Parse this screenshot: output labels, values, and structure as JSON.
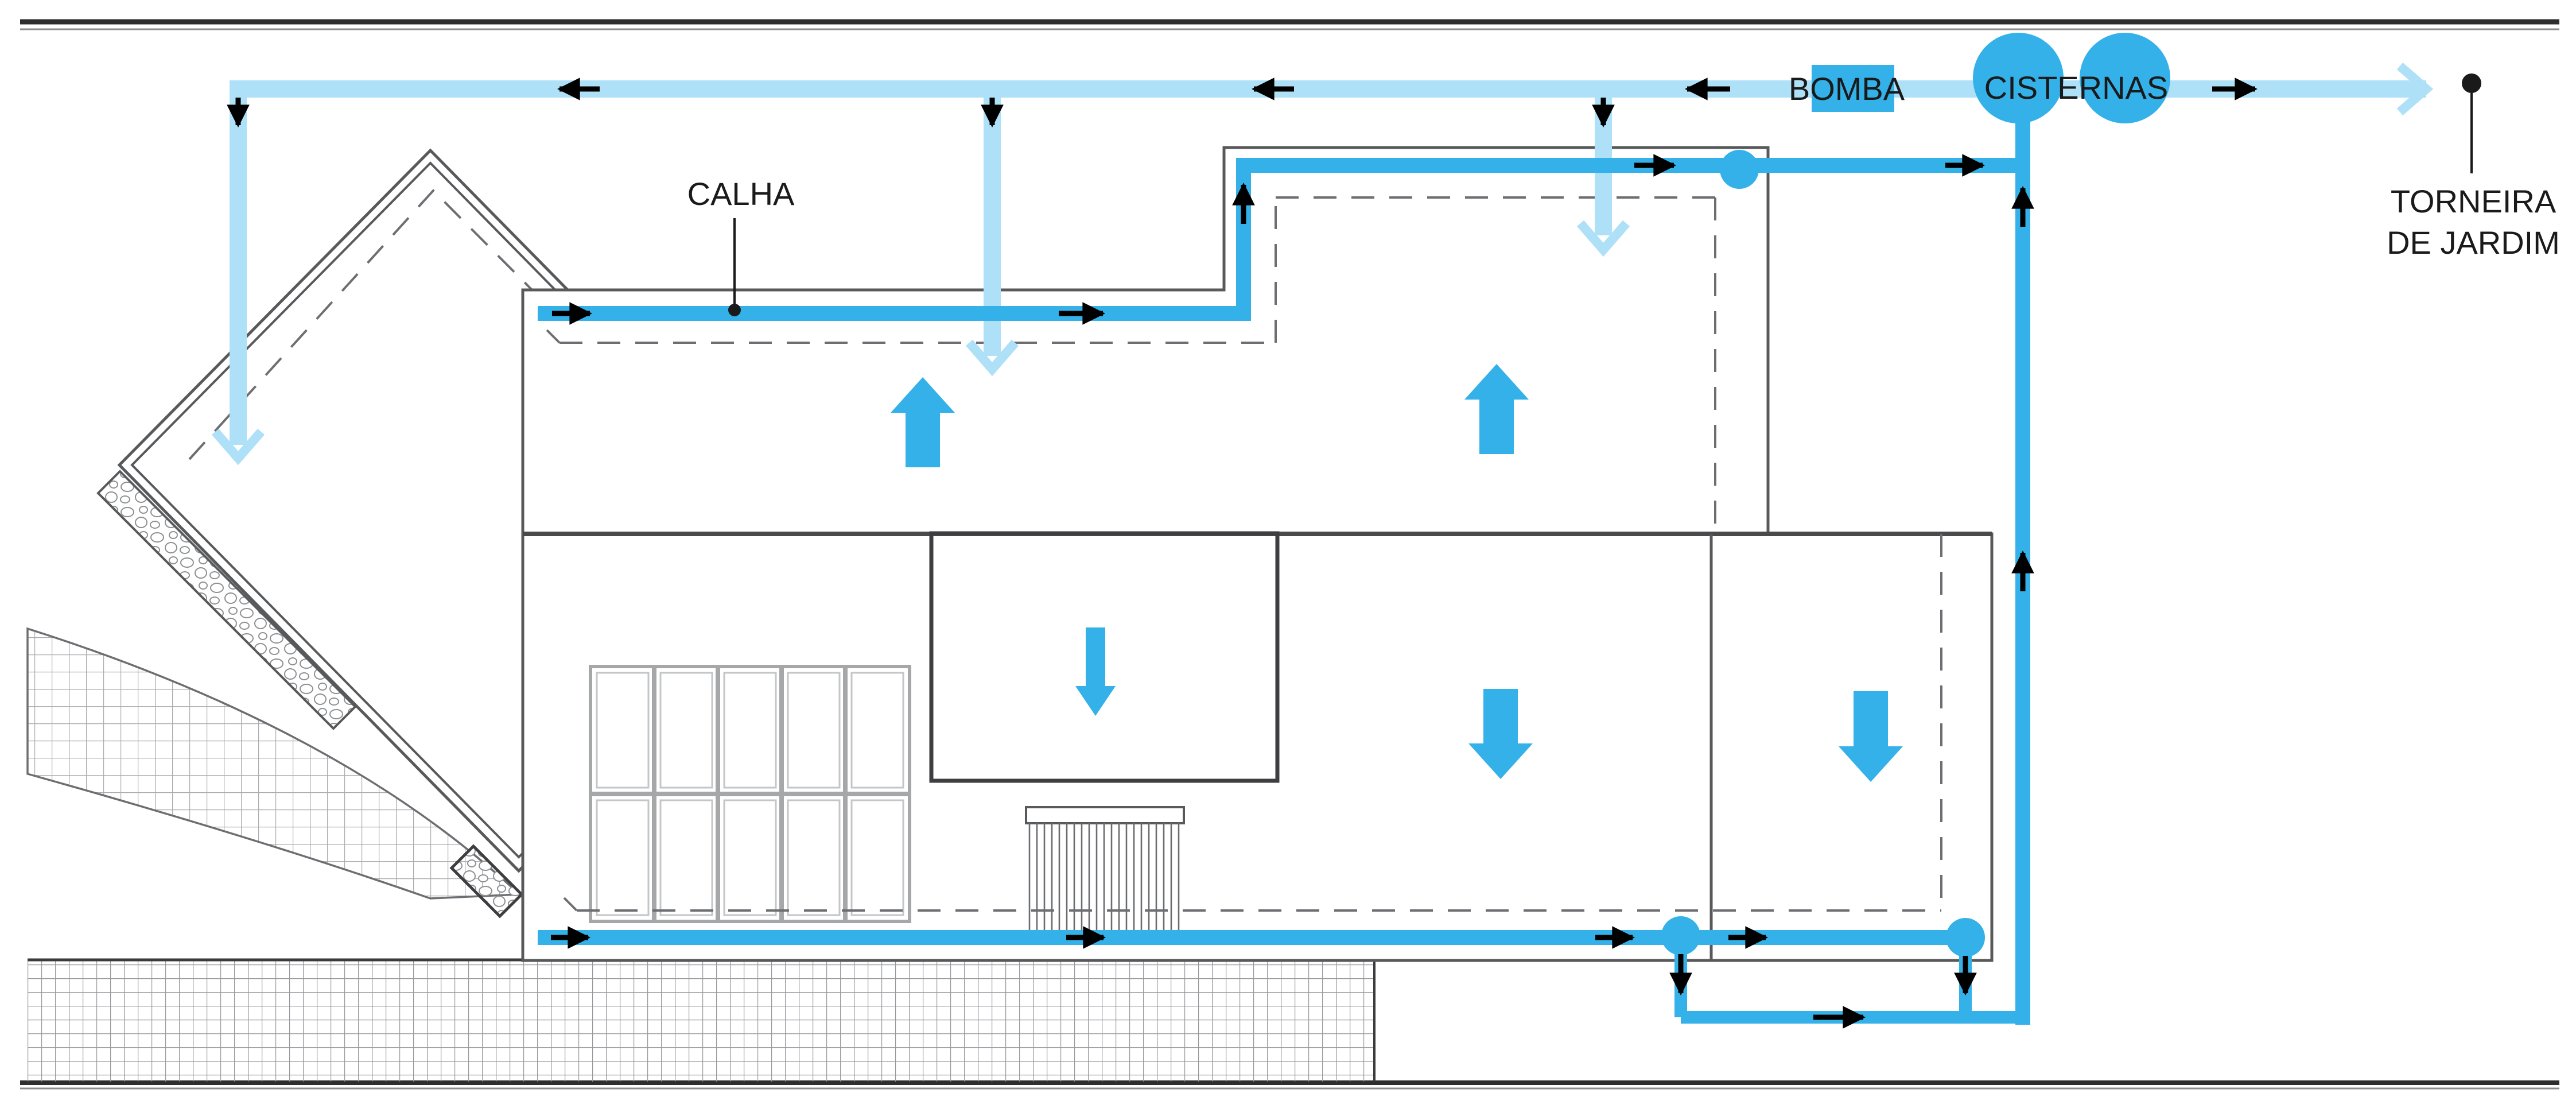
{
  "diagram": {
    "labels": {
      "calha": "CALHA",
      "bomba": "BOMBA",
      "cisternas": "CISTERNAS",
      "torneira_line1": "TORNEIRA",
      "torneira_line2": "DE JARDIM"
    },
    "colors": {
      "collection_pipe": "#33B1E8",
      "supply_pipe": "#AEE0F8",
      "flow_arrow": "#000000",
      "wall": "#58595B",
      "wall_dark": "#3E3E40",
      "dashed": "#6D6E71",
      "text": "#1A1A1A",
      "hatch": "#A9ABAD",
      "border_dark": "#2E2E2E",
      "border_gray": "#8C8C8C",
      "window_frame": "#A5A7A9",
      "window_frame_light": "#C4C5C7",
      "background": "#FFFFFF"
    }
  }
}
